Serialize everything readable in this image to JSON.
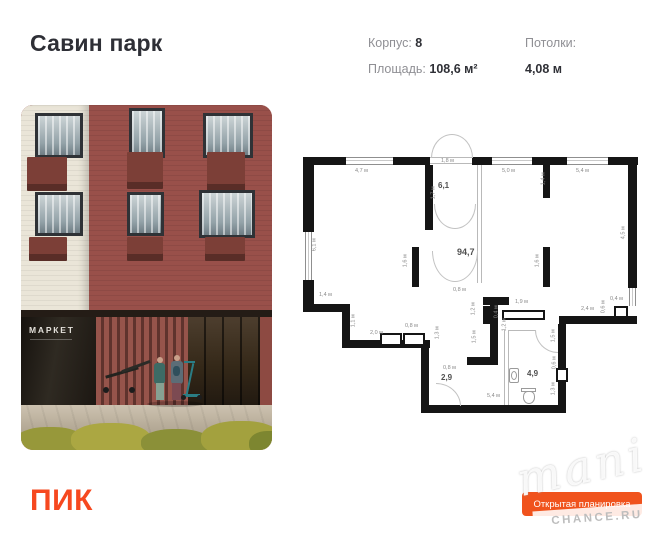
{
  "header": {
    "title": "Савин парк",
    "specs": [
      {
        "label": "Корпус:",
        "value": "8"
      },
      {
        "label": "Площадь:",
        "value": "108,6 м²"
      },
      {
        "label": "Потолки:",
        "value": "4,08 м"
      }
    ]
  },
  "photo": {
    "market_sign": "МАРКЕТ"
  },
  "plan": {
    "rooms": [
      {
        "t": "6,1",
        "x": 143,
        "y": 52,
        "s": 8
      },
      {
        "t": "94,7",
        "x": 162,
        "y": 118,
        "s": 9
      },
      {
        "t": "2,9",
        "x": 146,
        "y": 244,
        "s": 8
      },
      {
        "t": "4,9",
        "x": 232,
        "y": 240,
        "s": 8
      }
    ],
    "dims": [
      {
        "t": "4,7 м",
        "x": 60,
        "y": 39
      },
      {
        "t": "1,8 м",
        "x": 146,
        "y": 29
      },
      {
        "t": "5,0 м",
        "x": 207,
        "y": 39
      },
      {
        "t": "5,4 м",
        "x": 281,
        "y": 39
      },
      {
        "t": "1,7 м",
        "x": 133,
        "y": 60,
        "r": 1
      },
      {
        "t": "1,4 м",
        "x": 243,
        "y": 46,
        "r": 1
      },
      {
        "t": "6,1 м",
        "x": 14,
        "y": 112,
        "r": 1
      },
      {
        "t": "4,5 м",
        "x": 323,
        "y": 100,
        "r": 1
      },
      {
        "t": "1,6 м",
        "x": 105,
        "y": 128,
        "r": 1
      },
      {
        "t": "1,6 м",
        "x": 237,
        "y": 128,
        "r": 1
      },
      {
        "t": "1,4 м",
        "x": 24,
        "y": 163
      },
      {
        "t": "1,1 м",
        "x": 53,
        "y": 188,
        "r": 1
      },
      {
        "t": "2,0 м",
        "x": 75,
        "y": 201
      },
      {
        "t": "0,8 м",
        "x": 110,
        "y": 194
      },
      {
        "t": "0,8 м",
        "x": 158,
        "y": 158
      },
      {
        "t": "1,2 м",
        "x": 173,
        "y": 176,
        "r": 1
      },
      {
        "t": "1,5 м",
        "x": 174,
        "y": 204,
        "r": 1
      },
      {
        "t": "1,2 м",
        "x": 204,
        "y": 192,
        "r": 1
      },
      {
        "t": "1,9 м",
        "x": 220,
        "y": 170
      },
      {
        "t": "0,4 м",
        "x": 196,
        "y": 179,
        "r": 1
      },
      {
        "t": "2,4 м",
        "x": 286,
        "y": 177
      },
      {
        "t": "0,4 м",
        "x": 315,
        "y": 167
      },
      {
        "t": "0,6 м",
        "x": 303,
        "y": 174,
        "r": 1
      },
      {
        "t": "1,5 м",
        "x": 253,
        "y": 203,
        "r": 1
      },
      {
        "t": "0,6 м",
        "x": 254,
        "y": 230,
        "r": 1
      },
      {
        "t": "1,3 м",
        "x": 253,
        "y": 256,
        "r": 1
      },
      {
        "t": "0,8 м",
        "x": 148,
        "y": 236
      },
      {
        "t": "1,3 м",
        "x": 137,
        "y": 200,
        "r": 1
      },
      {
        "t": "5,4 м",
        "x": 192,
        "y": 264
      }
    ]
  },
  "footer": {
    "logo": "ПИК",
    "button": "Открытая планировка",
    "watermark_script": "mani",
    "watermark_site": "CHANCE.RU"
  },
  "colors": {
    "accent_orange": "#F6481F",
    "button_orange": "#F0531D",
    "wall_black": "#151515",
    "brick_red": "#99504A",
    "cream": "#EAE5D8"
  }
}
